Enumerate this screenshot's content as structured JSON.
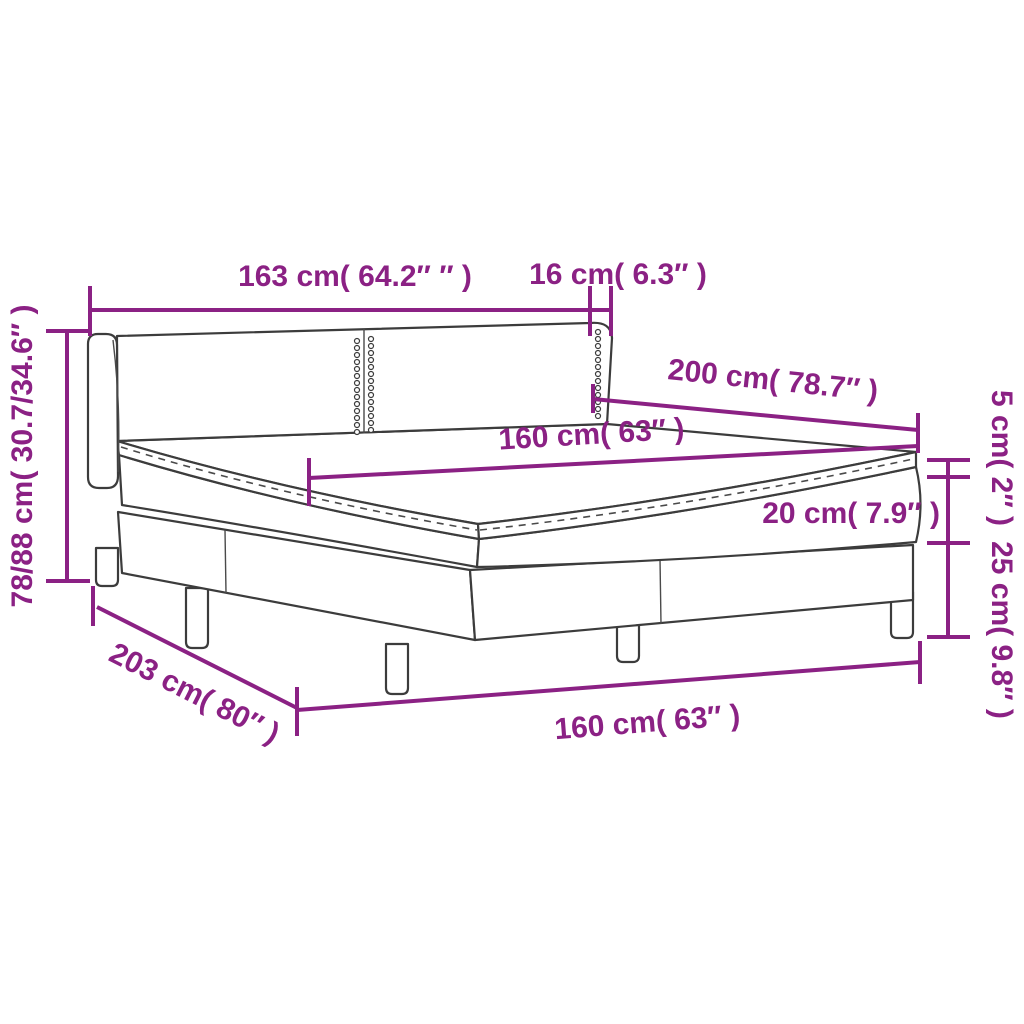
{
  "diagram": {
    "title": "Box spring bed dimension diagram",
    "product": "box-spring-bed-with-mattress-and-topper",
    "colors": {
      "accent": "#8B2184",
      "drawing_line": "#3C3C3C",
      "background": "#FFFFFF"
    },
    "dimensions": {
      "headboard_width": "163 cm( 64.2″ ″ )",
      "headboard_wing_depth": "16 cm( 6.3″ )",
      "total_height": "78/88 cm( 30.7/34.6″ )",
      "bed_length": "200 cm( 78.7″ )",
      "mattress_width_top": "160 cm( 63″ )",
      "topper_height": "5 cm( 2″ )",
      "mattress_height": "20 cm( 7.9″ )",
      "base_height": "25 cm( 9.8″ )",
      "total_length": "203 cm( 80″ )",
      "mattress_width_bottom": "160 cm( 63″ )"
    }
  }
}
